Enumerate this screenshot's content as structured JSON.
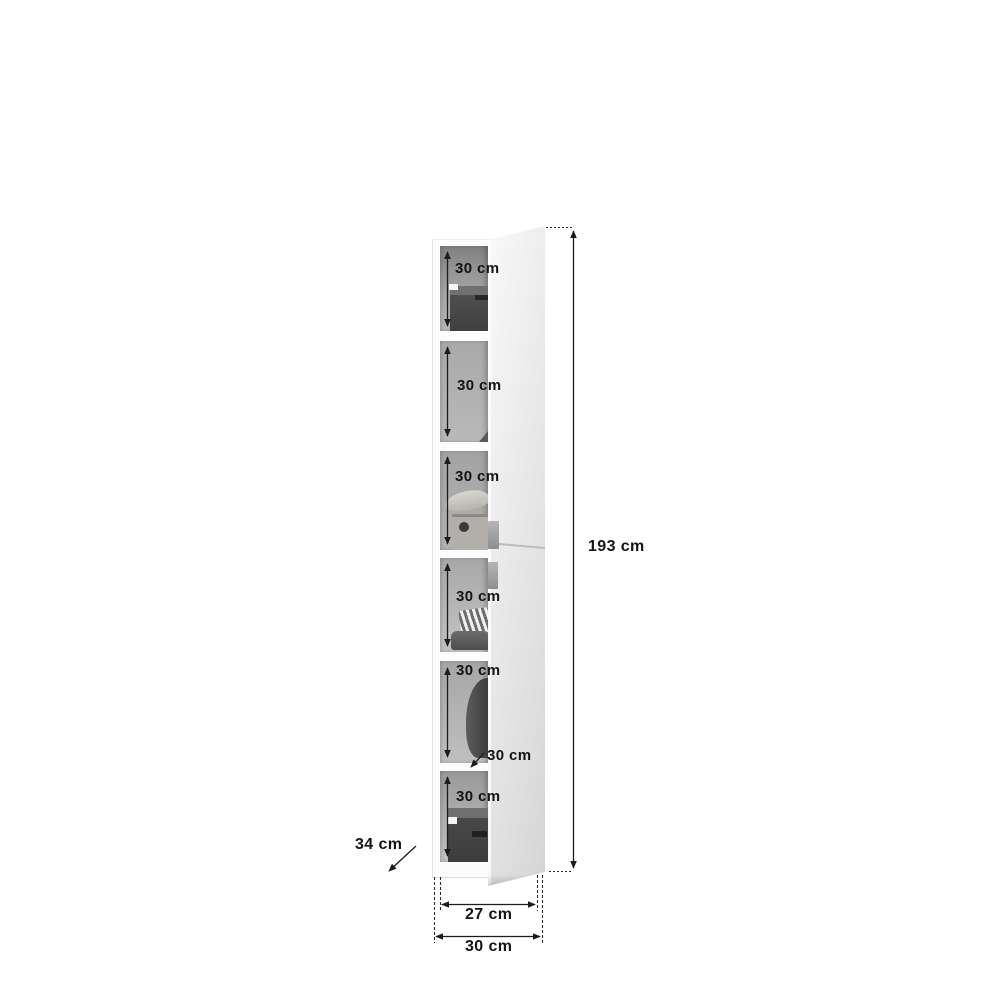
{
  "diagram": {
    "kind": "cabinet-dimension-diagram"
  },
  "compartments": [
    {
      "height_label": "30 cm"
    },
    {
      "height_label": "30 cm"
    },
    {
      "height_label": "30 cm"
    },
    {
      "height_label": "30 cm"
    },
    {
      "height_label": "30 cm"
    },
    {
      "height_label": "30 cm"
    }
  ],
  "dimensions": {
    "total_height": "193 cm",
    "inner_width": "27 cm",
    "outer_width": "30 cm",
    "depth": "34 cm",
    "shelf_pointer": "30 cm"
  },
  "colors": {
    "dimension_line": "#1c1c1c",
    "door_panel": "#e8e8e8",
    "compartment_back": "#a9a9a9",
    "handle": "#9e9e9e",
    "storage_box": "#4a4a4a"
  }
}
